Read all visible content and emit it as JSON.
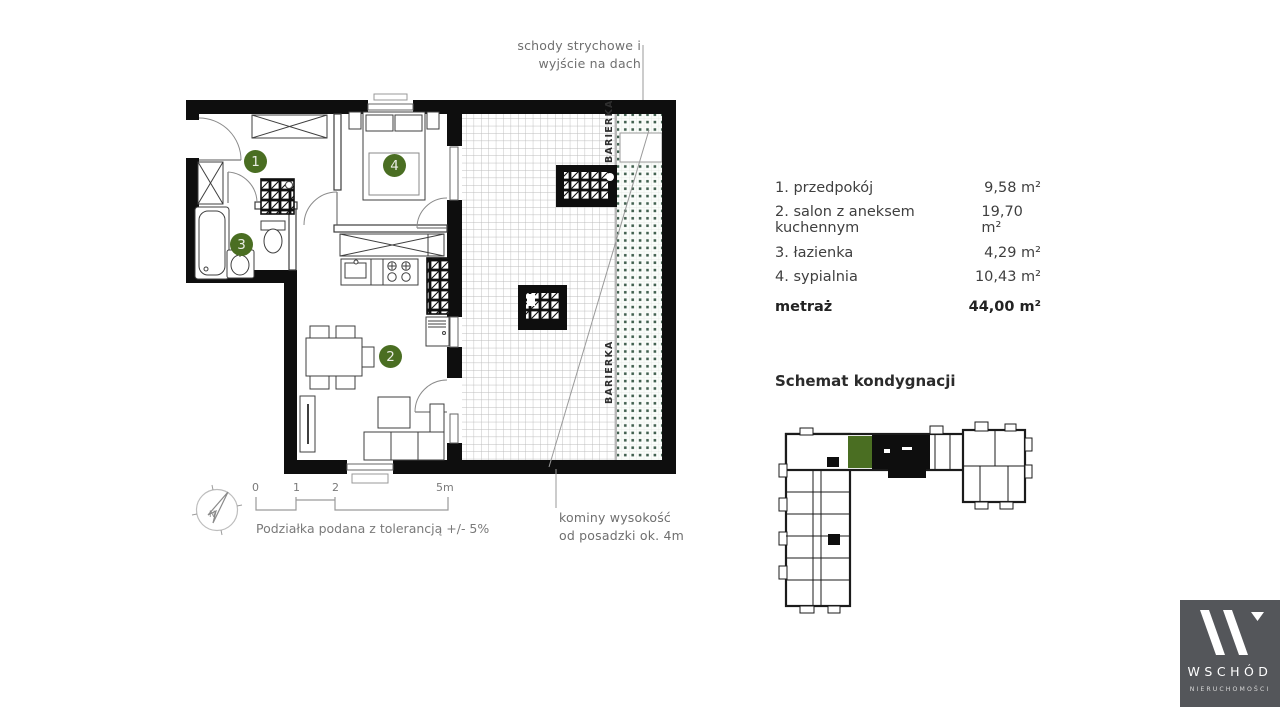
{
  "plan": {
    "annotation_top": {
      "line1": "schody strychowe i",
      "line2": "wyjście na dach"
    },
    "annotation_bottom": {
      "line1": "kominy wysokość",
      "line2": "od posadzki ok. 4m"
    },
    "barierka_label": "BARIERKA",
    "room_numbers": [
      "1",
      "2",
      "3",
      "4"
    ],
    "compass_label": "N",
    "scale": {
      "tick0": "0",
      "tick1": "1",
      "tick2": "2",
      "tick3": "5m",
      "tolerance_note": "Podziałka podana z tolerancją +/- 5%"
    }
  },
  "legend": {
    "rooms": [
      {
        "label": "1. przedpokój",
        "area": "9,58 m²"
      },
      {
        "label": "2. salon z aneksem kuchennym",
        "area": "19,70 m²"
      },
      {
        "label": "3. łazienka",
        "area": "4,29 m²"
      },
      {
        "label": "4. sypialnia",
        "area": "10,43 m²"
      }
    ],
    "total_label": "metraż",
    "total_area": "44,00 m²"
  },
  "schematic": {
    "title": "Schemat kondygnacji"
  },
  "logo": {
    "brand": "WSCHÓD",
    "subtitle": "NIERUCHOMOŚCI"
  },
  "colors": {
    "accent_green": "#4a6e22",
    "dot_green": "#41604f",
    "wall_black": "#0e0e0e",
    "logo_bg": "#54565a",
    "annotation_gray": "#6f6f6f"
  }
}
